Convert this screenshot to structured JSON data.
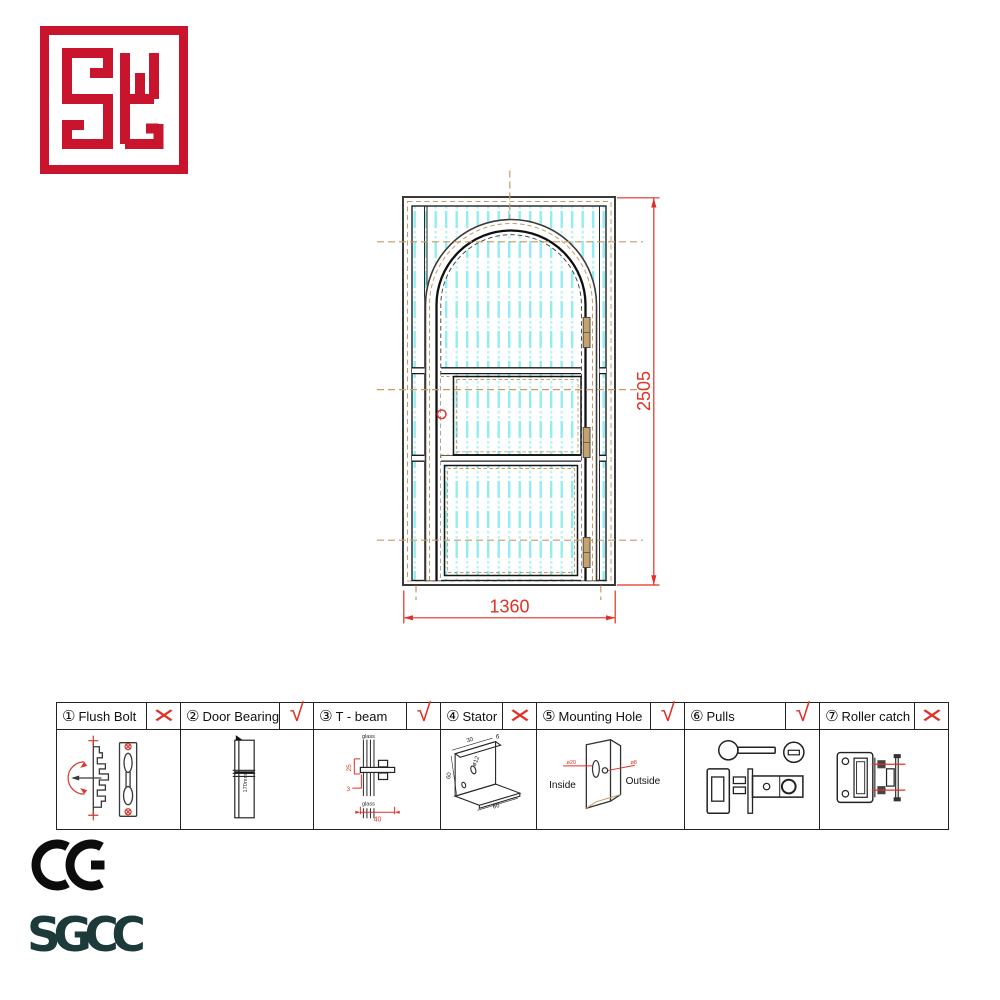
{
  "logo": {
    "text": "SY",
    "color": "#c8142d"
  },
  "drawing": {
    "height_label": "2505",
    "width_label": "1360",
    "colors": {
      "dimension_red": "#e03127",
      "centerline_tan": "#c79a62",
      "glass_cyan": "#8feef2",
      "hinge_tan": "#c9a26b"
    }
  },
  "parts_table": {
    "items": [
      {
        "num": "①",
        "label": "Flush Bolt",
        "mark": "✕",
        "mark_cls": "mark cross"
      },
      {
        "num": "②",
        "label": "Door Bearing",
        "mark": "√",
        "mark_cls": "mark check",
        "annotations": {
          "length": "170mm"
        }
      },
      {
        "num": "③",
        "label": "T - beam",
        "mark": "√",
        "mark_cls": "mark check",
        "annotations": {
          "glass_top": "glass",
          "glass_bottom": "glass",
          "d25": "25",
          "d3": "3",
          "d40": "40"
        }
      },
      {
        "num": "④",
        "label": "Stator",
        "mark": "✕",
        "mark_cls": "mark cross",
        "annotations": {
          "d30": "30",
          "d6": "6",
          "d12": "ø12",
          "d60_left": "60",
          "d60_bottom": "60"
        }
      },
      {
        "num": "⑤",
        "label": "Mounting Hole",
        "mark": "√",
        "mark_cls": "mark check",
        "annotations": {
          "inside": "Inside",
          "outside": "Outside",
          "d20": "ø20",
          "d8": "ø8"
        }
      },
      {
        "num": "⑥",
        "label": "Pulls",
        "mark": "√",
        "mark_cls": "mark check"
      },
      {
        "num": "⑦",
        "label": "Roller catch",
        "mark": "✕",
        "mark_cls": "mark cross"
      }
    ]
  },
  "certifications": {
    "ce": "CE",
    "sgcc": "SGCC"
  }
}
